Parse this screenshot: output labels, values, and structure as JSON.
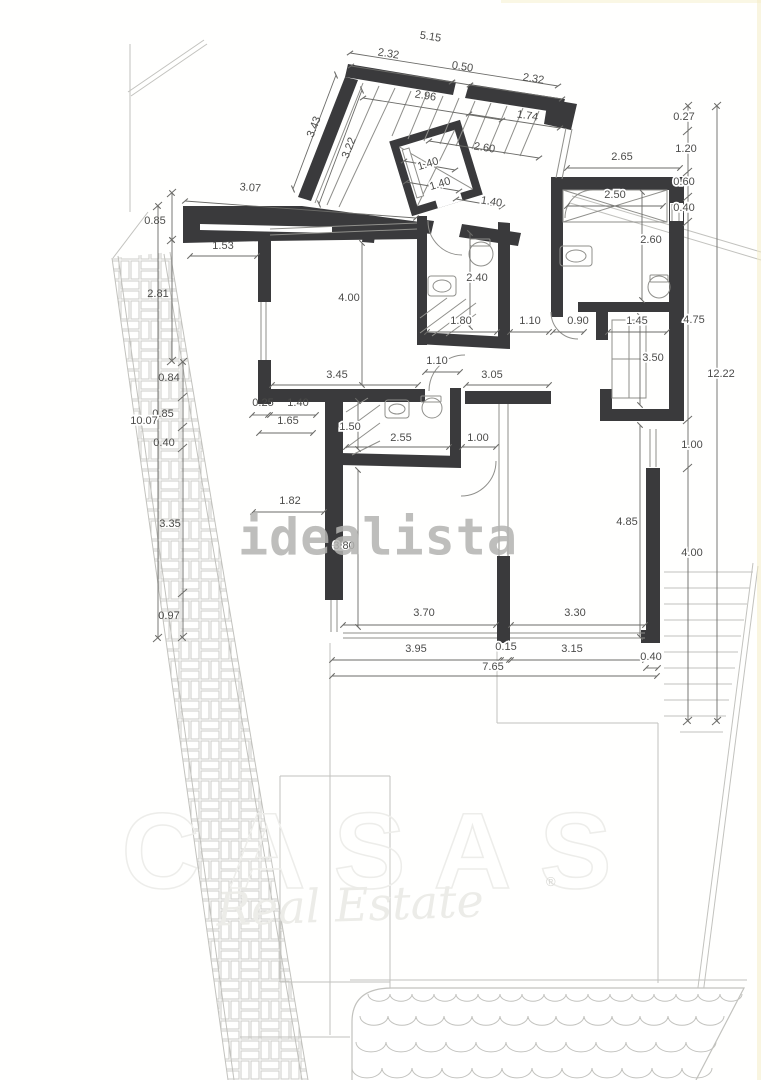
{
  "watermarks": {
    "idealista": "idealista",
    "brand": "CASAS",
    "brand_sub": "Real Estate",
    "registered": "®"
  },
  "colors": {
    "wall": "#3a3a3c",
    "dim": "#55555",
    "dim_line": "#6b6b68",
    "med_line": "#8f8f8b",
    "light_line": "#c2c2be",
    "pattern_line": "#cdcdc9",
    "watermark_gray": "#b3b3b1",
    "background": "#fffffe"
  },
  "plan": {
    "walls": [
      "348,64 456,82 453,95 345,77",
      "469,84 565,99 561,113 465,98",
      "548,99 577,104 571,130 544,124",
      "345,77 358,80 311,201 298,197",
      "183,206 302,206 420,222 420,239 268,241 183,243",
      "462,224 521,233 518,246 459,237",
      "418,219 434,221 431,234 415,232",
      "551,177 684,177 684,190 551,190",
      "669,190 684,190 684,421 669,421",
      "551,190 563,190 563,317 551,317",
      "578,302 669,302 669,312 578,312",
      "596,312 608,312 608,340 596,340",
      "600,389 612,389 612,409 684,409 684,421 600,421",
      "646,468 660,468 660,643 641,643 641,630 646,630",
      "417,216 427,216 427,345 417,345",
      "498,222 510,223 510,340 498,340",
      "417,332 510,337 510,349 417,344",
      "271,389 425,389 425,402 271,402",
      "465,391 551,391 551,404 465,404",
      "258,238 271,238 271,302 258,302",
      "258,360 271,360 271,404 258,404",
      "325,390 343,390 343,600 325,600",
      "450,388 461,388 461,462 450,462",
      "340,453 461,456 461,468 340,465",
      "497,556 510,556 510,643 497,643",
      "365,219 377,220 374,243 362,242"
    ],
    "white_overlays": [
      "200,224 332,227 332,233 200,230",
      "670,203 683,203 683,221 670,221"
    ],
    "lift": {
      "transform": "rotate(-17 436 168)",
      "box": [
        403,
        133,
        66,
        70
      ],
      "cross": [
        [
          407,
          137,
          465,
          199
        ],
        [
          465,
          137,
          407,
          199
        ]
      ],
      "slot": [
        409,
        141,
        7,
        50
      ],
      "door": [
        426,
        198,
        26,
        9
      ]
    },
    "light_lines": [
      [
        128,
        92,
        204,
        40
      ],
      [
        131,
        96,
        207,
        44
      ],
      [
        130,
        44,
        130,
        212
      ],
      [
        148,
        212,
        113,
        258
      ],
      [
        112,
        258,
        228,
        1080
      ],
      [
        118,
        256,
        234,
        1080
      ],
      [
        170,
        252,
        308,
        1080
      ],
      [
        164,
        254,
        302,
        1080
      ],
      [
        570,
        203,
        761,
        260
      ],
      [
        572,
        196,
        761,
        252
      ],
      [
        753,
        563,
        686,
        1080
      ],
      [
        758,
        566,
        692,
        1080
      ],
      [
        330,
        643,
        330,
        1035
      ],
      [
        390,
        776,
        390,
        1035
      ],
      [
        497,
        643,
        497,
        723
      ],
      [
        497,
        723,
        658,
        723
      ],
      [
        658,
        723,
        658,
        983
      ],
      [
        280,
        776,
        390,
        776
      ],
      [
        280,
        776,
        280,
        982
      ],
      [
        280,
        982,
        390,
        982
      ],
      [
        240,
        1037,
        350,
        1037
      ],
      [
        350,
        980,
        747,
        980
      ],
      [
        664,
        572,
        753,
        572
      ],
      [
        664,
        588,
        750,
        588
      ],
      [
        664,
        604,
        747,
        604
      ],
      [
        664,
        620,
        744,
        620
      ],
      [
        664,
        636,
        741,
        636
      ],
      [
        664,
        652,
        738,
        652
      ],
      [
        664,
        668,
        735,
        668
      ],
      [
        664,
        684,
        732,
        684
      ],
      [
        664,
        700,
        729,
        700
      ],
      [
        664,
        716,
        726,
        716
      ],
      [
        680,
        732,
        723,
        732
      ]
    ],
    "band_polygon": "112,258 170,252 308,1080 228,1080",
    "pool_path": "M 352,1080 L 352,1022 Q 352,988 392,988 L 744,988 L 696,1080",
    "waves": [
      {
        "y": 994,
        "x1": 368,
        "x2": 742,
        "w": 22
      },
      {
        "y": 1016,
        "x1": 360,
        "x2": 744,
        "w": 28
      },
      {
        "y": 1042,
        "x1": 356,
        "x2": 738,
        "w": 30
      },
      {
        "y": 1068,
        "x1": 352,
        "x2": 730,
        "w": 30
      }
    ],
    "med_lines": [
      [
        261,
        302,
        261,
        360
      ],
      [
        266,
        302,
        266,
        360
      ],
      [
        672,
        204,
        672,
        221
      ],
      [
        679,
        204,
        679,
        221
      ],
      [
        650,
        429,
        650,
        467
      ],
      [
        656,
        429,
        656,
        467
      ],
      [
        343,
        633,
        497,
        633
      ],
      [
        343,
        638,
        497,
        638
      ],
      [
        510,
        633,
        645,
        633
      ],
      [
        510,
        638,
        645,
        638
      ],
      [
        566,
        128,
        556,
        178
      ],
      [
        572,
        129,
        562,
        179
      ],
      [
        270,
        229,
        417,
        223
      ],
      [
        270,
        235,
        417,
        229
      ],
      [
        331,
        600,
        331,
        632
      ],
      [
        337,
        600,
        337,
        632
      ],
      [
        499,
        404,
        499,
        556
      ],
      [
        508,
        404,
        508,
        556
      ],
      [
        563,
        190,
        667,
        222
      ],
      [
        563,
        222,
        667,
        190
      ],
      [
        612,
        359,
        646,
        359
      ],
      [
        629,
        320,
        629,
        398
      ],
      [
        420,
        318,
        447,
        298
      ],
      [
        420,
        333,
        466,
        299
      ],
      [
        432,
        336,
        476,
        303
      ],
      [
        446,
        336,
        476,
        314
      ],
      [
        346,
        412,
        368,
        398
      ],
      [
        346,
        430,
        380,
        405
      ],
      [
        346,
        448,
        380,
        423
      ],
      [
        352,
        455,
        380,
        441
      ],
      [
        363,
        83,
        315,
        203
      ],
      [
        379,
        86,
        327,
        205
      ],
      [
        395,
        88,
        339,
        207
      ],
      [
        411,
        91,
        392,
        136
      ],
      [
        427,
        93,
        408,
        139
      ],
      [
        443,
        96,
        424,
        141
      ],
      [
        459,
        98,
        440,
        144
      ],
      [
        475,
        101,
        456,
        146
      ],
      [
        491,
        103,
        472,
        149
      ],
      [
        507,
        106,
        488,
        151
      ],
      [
        523,
        108,
        504,
        154
      ],
      [
        539,
        111,
        520,
        156
      ]
    ],
    "arcs": [
      "M 428,221 A 34 34 0 0 0 462,255",
      "M 593,190 A 28 28 0 0 0 565,218",
      "M 551,312 A 27 27 0 0 0 578,339",
      "M 465,355 A 36 36 0 0 0 429,391",
      "M 496,461 A 35 35 0 0 1 461,496"
    ],
    "fixture_rects": [
      [
        560,
        246,
        32,
        20,
        3
      ],
      [
        428,
        276,
        28,
        20,
        3
      ],
      [
        385,
        400,
        24,
        18,
        3
      ],
      [
        650,
        275,
        18,
        7,
        1
      ],
      [
        470,
        239,
        20,
        7,
        1
      ],
      [
        421,
        396,
        20,
        6,
        1
      ],
      [
        563,
        190,
        104,
        32,
        0
      ],
      [
        612,
        320,
        34,
        78,
        0
      ]
    ],
    "circles": [
      [
        481,
        254,
        12
      ],
      [
        659,
        287,
        11
      ],
      [
        432,
        408,
        10
      ]
    ],
    "ellipses": [
      [
        576,
        256,
        10,
        6
      ],
      [
        442,
        286,
        9,
        6
      ],
      [
        397,
        409,
        8,
        5
      ]
    ],
    "dim_lines": [
      [
        350,
        53,
        558,
        86
      ],
      [
        351,
        66,
        452,
        82
      ],
      [
        452,
        82,
        470,
        85
      ],
      [
        470,
        85,
        562,
        99
      ],
      [
        363,
        98,
        502,
        120
      ],
      [
        469,
        114,
        560,
        128
      ],
      [
        429,
        141,
        539,
        158
      ],
      [
        293,
        189,
        336,
        75
      ],
      [
        319,
        204,
        362,
        90
      ],
      [
        185,
        201,
        416,
        218
      ],
      [
        567,
        168,
        680,
        168
      ],
      [
        567,
        206,
        663,
        206
      ],
      [
        642,
        192,
        642,
        300
      ],
      [
        688,
        106,
        688,
        721
      ],
      [
        717,
        106,
        717,
        721
      ],
      [
        172,
        193,
        172,
        240
      ],
      [
        172,
        240,
        172,
        361
      ],
      [
        158,
        206,
        158,
        638
      ],
      [
        183,
        362,
        183,
        638
      ],
      [
        190,
        256,
        257,
        256
      ],
      [
        362,
        243,
        362,
        385
      ],
      [
        470,
        233,
        470,
        327
      ],
      [
        427,
        332,
        497,
        332
      ],
      [
        510,
        332,
        549,
        332
      ],
      [
        553,
        332,
        584,
        332
      ],
      [
        608,
        332,
        667,
        332
      ],
      [
        272,
        385,
        418,
        385
      ],
      [
        425,
        372,
        460,
        372
      ],
      [
        466,
        385,
        549,
        385
      ],
      [
        640,
        316,
        640,
        405
      ],
      [
        252,
        415,
        268,
        415
      ],
      [
        270,
        415,
        316,
        415
      ],
      [
        259,
        433,
        313,
        433
      ],
      [
        358,
        401,
        358,
        449
      ],
      [
        346,
        447,
        449,
        447
      ],
      [
        462,
        447,
        496,
        447
      ],
      [
        253,
        512,
        324,
        512
      ],
      [
        358,
        470,
        358,
        627
      ],
      [
        640,
        425,
        640,
        637
      ],
      [
        343,
        625,
        496,
        625
      ],
      [
        511,
        625,
        645,
        625
      ],
      [
        332,
        660,
        499,
        660
      ],
      [
        501,
        660,
        509,
        660
      ],
      [
        511,
        660,
        645,
        660
      ],
      [
        646,
        668,
        658,
        668
      ],
      [
        332,
        676,
        657,
        676
      ],
      [
        404,
        161,
        455,
        170
      ],
      [
        406,
        182,
        459,
        191
      ],
      [
        456,
        199,
        502,
        207
      ]
    ],
    "chain_ticks": [
      [
        683,
        110,
        692,
        102
      ],
      [
        683,
        135,
        692,
        127
      ],
      [
        683,
        176,
        692,
        168
      ],
      [
        683,
        201,
        692,
        193
      ],
      [
        683,
        226,
        692,
        218
      ],
      [
        683,
        424,
        692,
        416
      ],
      [
        683,
        472,
        692,
        464
      ],
      [
        683,
        725,
        692,
        717
      ],
      [
        712,
        110,
        721,
        102
      ],
      [
        712,
        725,
        721,
        717
      ],
      [
        178,
        366,
        187,
        358
      ],
      [
        178,
        401,
        187,
        393
      ],
      [
        178,
        431,
        187,
        423
      ],
      [
        178,
        452,
        187,
        444
      ],
      [
        178,
        597,
        187,
        589
      ],
      [
        178,
        641,
        187,
        633
      ],
      [
        167,
        197,
        176,
        189
      ],
      [
        167,
        244,
        176,
        236
      ],
      [
        167,
        365,
        176,
        357
      ],
      [
        153,
        210,
        162,
        202
      ],
      [
        153,
        642,
        162,
        634
      ]
    ],
    "dim_labels": [
      {
        "t": "5.15",
        "x": 430,
        "y": 40,
        "r": 9
      },
      {
        "t": "2.32",
        "x": 388,
        "y": 57,
        "r": 9
      },
      {
        "t": "0.50",
        "x": 462,
        "y": 70,
        "r": 9
      },
      {
        "t": "2.32",
        "x": 533,
        "y": 82,
        "r": 9
      },
      {
        "t": "2.96",
        "x": 425,
        "y": 99,
        "r": 9
      },
      {
        "t": "1.74",
        "x": 527,
        "y": 119,
        "r": 9
      },
      {
        "t": "2.60",
        "x": 484,
        "y": 151,
        "r": 9
      },
      {
        "t": "3.43",
        "x": 317,
        "y": 128,
        "r": -69
      },
      {
        "t": "3.22",
        "x": 352,
        "y": 149,
        "r": -69
      },
      {
        "t": "1.40",
        "x": 429,
        "y": 167,
        "r": -17,
        "h": 1
      },
      {
        "t": "1.40",
        "x": 441,
        "y": 187,
        "r": -17,
        "h": 1
      },
      {
        "t": "1.40",
        "x": 491,
        "y": 205,
        "r": 9,
        "h": 1
      },
      {
        "t": "3.07",
        "x": 250,
        "y": 191,
        "r": 5
      },
      {
        "t": "2.65",
        "x": 622,
        "y": 160,
        "r": 0
      },
      {
        "t": "0.27",
        "x": 684,
        "y": 120,
        "r": 0,
        "h": 1
      },
      {
        "t": "1.20",
        "x": 686,
        "y": 152,
        "r": 0,
        "h": 1
      },
      {
        "t": "0.60",
        "x": 684,
        "y": 185,
        "r": 0,
        "h": 1
      },
      {
        "t": "0.40",
        "x": 684,
        "y": 211,
        "r": 0,
        "h": 1
      },
      {
        "t": "2.50",
        "x": 615,
        "y": 198,
        "r": 0,
        "h": 1
      },
      {
        "t": "2.60",
        "x": 651,
        "y": 243,
        "r": 0,
        "h": 1
      },
      {
        "t": "0.85",
        "x": 155,
        "y": 224,
        "r": 0
      },
      {
        "t": "1.53",
        "x": 223,
        "y": 249,
        "r": 0
      },
      {
        "t": "2.81",
        "x": 158,
        "y": 297,
        "r": 0
      },
      {
        "t": "4.00",
        "x": 349,
        "y": 301,
        "r": 0,
        "h": 1
      },
      {
        "t": "2.40",
        "x": 477,
        "y": 281,
        "r": 0,
        "h": 1
      },
      {
        "t": "1.80",
        "x": 461,
        "y": 324,
        "r": 0,
        "h": 1
      },
      {
        "t": "1.10",
        "x": 530,
        "y": 324,
        "r": 0,
        "h": 1
      },
      {
        "t": "0.90",
        "x": 578,
        "y": 324,
        "r": 0,
        "h": 1
      },
      {
        "t": "1.45",
        "x": 637,
        "y": 324,
        "r": 0,
        "h": 1
      },
      {
        "t": "4.75",
        "x": 694,
        "y": 323,
        "r": 0,
        "h": 1
      },
      {
        "t": "3.45",
        "x": 337,
        "y": 378,
        "r": 0,
        "h": 1
      },
      {
        "t": "1.10",
        "x": 437,
        "y": 364,
        "r": 0,
        "h": 1
      },
      {
        "t": "3.05",
        "x": 492,
        "y": 378,
        "r": 0,
        "h": 1
      },
      {
        "t": "3.50",
        "x": 653,
        "y": 361,
        "r": 0,
        "h": 1
      },
      {
        "t": "12.22",
        "x": 721,
        "y": 377,
        "r": 0,
        "h": 1
      },
      {
        "t": "0.84",
        "x": 169,
        "y": 381,
        "r": 0
      },
      {
        "t": "0.85",
        "x": 163,
        "y": 417,
        "r": 0
      },
      {
        "t": "0.40",
        "x": 164,
        "y": 446,
        "r": 0
      },
      {
        "t": "10.07",
        "x": 144,
        "y": 424,
        "r": 0,
        "h": 1
      },
      {
        "t": "0.25",
        "x": 263,
        "y": 406,
        "r": 0
      },
      {
        "t": "1.40",
        "x": 298,
        "y": 406,
        "r": 0
      },
      {
        "t": "1.65",
        "x": 288,
        "y": 424,
        "r": 0
      },
      {
        "t": "1.50",
        "x": 350,
        "y": 430,
        "r": 0,
        "h": 1
      },
      {
        "t": "2.55",
        "x": 401,
        "y": 441,
        "r": 0,
        "h": 1
      },
      {
        "t": "1.00",
        "x": 478,
        "y": 441,
        "r": 0,
        "h": 1
      },
      {
        "t": "3.35",
        "x": 170,
        "y": 527,
        "r": 0
      },
      {
        "t": "1.82",
        "x": 290,
        "y": 504,
        "r": 0
      },
      {
        "t": "3.80",
        "x": 344,
        "y": 549,
        "r": 0,
        "h": 1
      },
      {
        "t": "4.85",
        "x": 627,
        "y": 525,
        "r": 0,
        "h": 1
      },
      {
        "t": "1.00",
        "x": 692,
        "y": 448,
        "r": 0,
        "h": 1
      },
      {
        "t": "4.00",
        "x": 692,
        "y": 556,
        "r": 0,
        "h": 1
      },
      {
        "t": "0.97",
        "x": 169,
        "y": 619,
        "r": 0
      },
      {
        "t": "3.70",
        "x": 424,
        "y": 616,
        "r": 0,
        "h": 1
      },
      {
        "t": "3.30",
        "x": 575,
        "y": 616,
        "r": 0,
        "h": 1
      },
      {
        "t": "3.95",
        "x": 416,
        "y": 652,
        "r": 0,
        "h": 1
      },
      {
        "t": "0.15",
        "x": 506,
        "y": 650,
        "r": 0,
        "h": 1
      },
      {
        "t": "3.15",
        "x": 572,
        "y": 652,
        "r": 0,
        "h": 1
      },
      {
        "t": "0.40",
        "x": 651,
        "y": 660,
        "r": 0,
        "h": 1
      },
      {
        "t": "7.65",
        "x": 493,
        "y": 670,
        "r": 0,
        "h": 1
      }
    ]
  }
}
